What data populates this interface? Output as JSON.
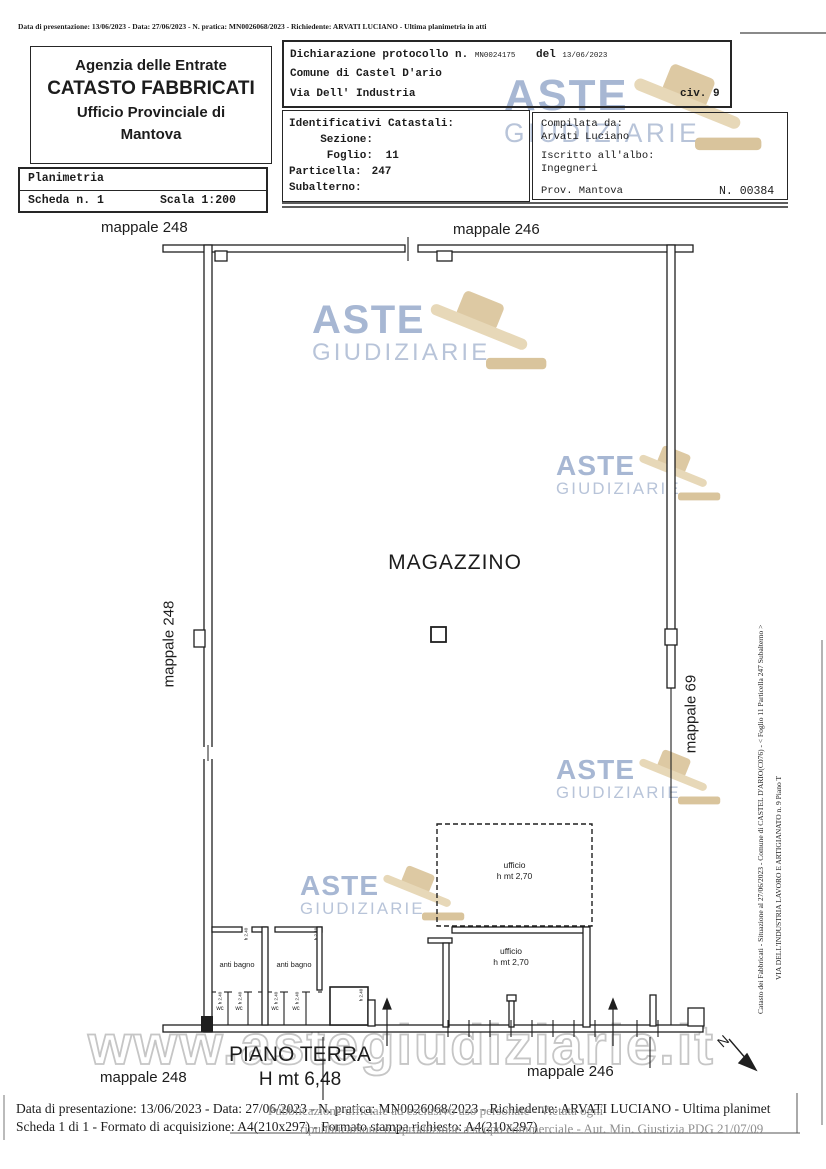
{
  "top_note": "Data di presentazione: 13/06/2023 - Data: 27/06/2023 - N. pratica: MN0026068/2023 - Richiedente: ARVATI LUCIANO - Ultima planimetria in atti",
  "header": {
    "agency": {
      "line1": "Agenzia delle Entrate",
      "line2": "CATASTO FABBRICATI",
      "line3": "Ufficio Provinciale di",
      "line4": "Mantova"
    },
    "declaration": {
      "protocol_label": "Dichiarazione protocollo n.",
      "protocol_number": "MN0024175",
      "del_label": "del",
      "protocol_date": "13/06/2023",
      "comune": "Comune di Castel D'ario",
      "street": "Via Dell' Industria",
      "civ": "civ. 9"
    },
    "identifiers": {
      "title": "Identificativi Catastali:",
      "sezione_label": "Sezione:",
      "foglio_label": "Foglio:",
      "foglio_value": "11",
      "particella_label": "Particella:",
      "particella_value": "247",
      "subalterno_label": "Subalterno:"
    },
    "compiled": {
      "compilata_label": "Compilata da:",
      "compilata_value": "Arvati Luciano",
      "albo_label": "Iscritto all'albo:",
      "albo_value": "Ingegneri",
      "prov": "Prov. Mantova",
      "number": "N. 00384"
    },
    "sheet": {
      "title": "Planimetria",
      "scheda": "Scheda n. 1",
      "scala": "Scala 1:200"
    }
  },
  "plan": {
    "mappale_top_left": "mappale 248",
    "mappale_top_right": "mappale 246",
    "mappale_left": "mappale 248",
    "mappale_right": "mappale 69",
    "mappale_bottom_left": "mappale 248",
    "mappale_bottom_right": "mappale 246",
    "main_room": "MAGAZZINO",
    "floor_label": "PIANO TERRA",
    "floor_height": "H mt 6,48",
    "office_upper_name": "ufficio",
    "office_upper_height": "h mt 2,70",
    "office_lower_name": "ufficio",
    "office_lower_height": "h mt 2,70",
    "anti_bagno": "anti bagno",
    "wc": "wc",
    "small_height_note": "h 2.40",
    "north_label": "N"
  },
  "side_note": {
    "line1": "Catasto dei Fabbricati - Situazione al 27/06/2023 - Comune di CASTEL D'ARIO(C076) - < Foglio 11 Particella 247 Subalterno    >",
    "line2": "VIA DELL'INDUSTRIA LAVORO E ARTIGIANATO n. 9 Piano T"
  },
  "watermarks": {
    "aste": "ASTE",
    "giudiziarie": "GIUDIZIARIE",
    "website": "www.astegiudiziarie.it",
    "disclaimer_line1": "Pubblicazione ufficiale ad esclusivo uso personale - Vietata ogni",
    "disclaimer_line2": "ripubblicazione o riproduzione a scopo commerciale - Aut. Min. Giustizia PDG 21/07/09",
    "colors": {
      "text_blue": "#a7b7d3",
      "text_blue_light": "#b8c4d9",
      "gavel_tan": "#ddc9a3",
      "outline_gray": "#c6c6c6"
    }
  },
  "footer": {
    "line1": "Data di presentazione: 13/06/2023 - Data: 27/06/2023 - N. pratica: MN0026068/2023 - Richiedente: ARVATI LUCIANO - Ultima planimet",
    "line2": "Scheda 1 di 1 - Formato di acquisizione: A4(210x297) - Formato stampa richiesto: A4(210x297)"
  },
  "icons": {
    "gavel": "gavel-icon",
    "north_arrow": "north-arrow-icon"
  }
}
